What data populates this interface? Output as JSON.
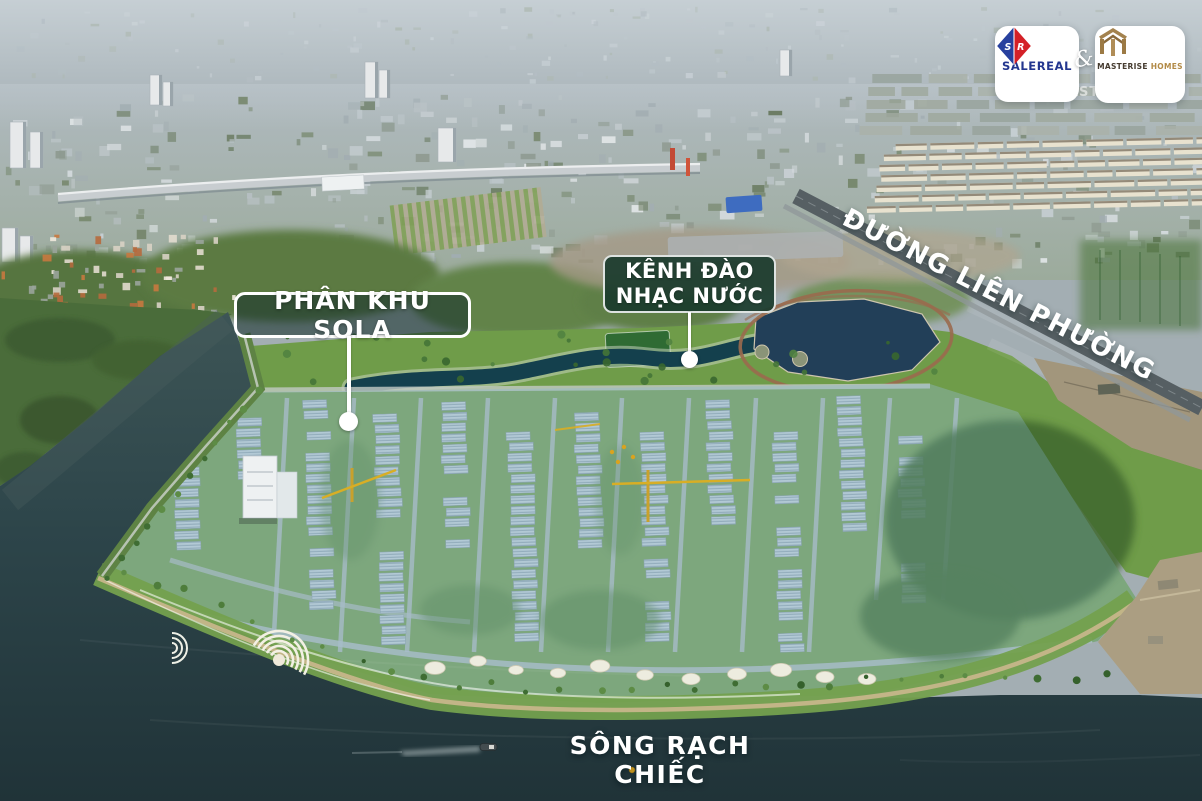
{
  "branding": {
    "connector": "&",
    "watermark": "AST",
    "salereal": {
      "name": "SALEREAL",
      "monogram_left": "S",
      "monogram_right": "R"
    },
    "masterise": {
      "name_primary": "MASTERISE",
      "name_secondary": "HOMES"
    }
  },
  "map_labels": {
    "subdivision": "PHÂN KHU SOLA",
    "canal_line1": "KÊNH ĐÀO",
    "canal_line2": "NHẠC NƯỚC",
    "road": "ĐƯỜNG LIÊN PHƯỜNG",
    "river": "SÔNG RẠCH CHIẾC"
  },
  "colors": {
    "label_background": "#1a3b2d",
    "river_water": "#243b40",
    "canal_water": "#14404d",
    "site_tint": "#7fb3d9",
    "salereal_blue": "#27409e",
    "salereal_red": "#d42127",
    "masterise_gold": "#a0793f",
    "masterise_dark": "#433a2e"
  }
}
